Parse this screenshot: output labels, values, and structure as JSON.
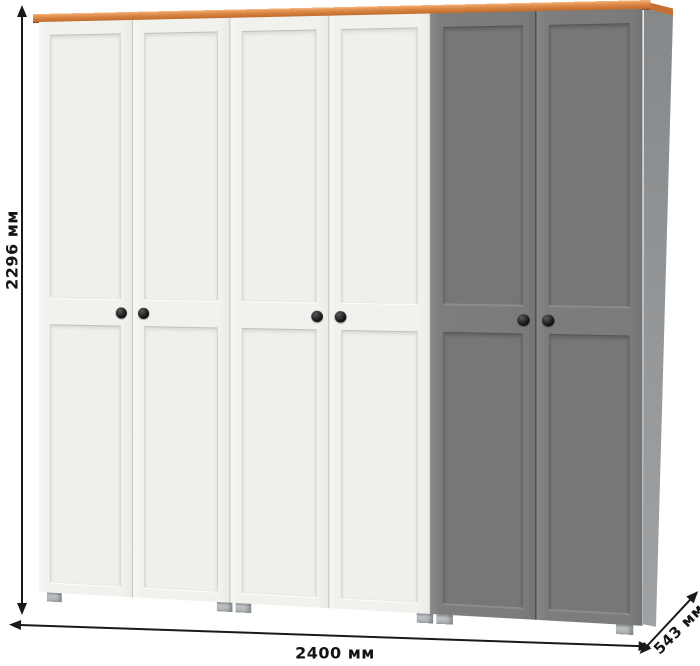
{
  "image": {
    "description": "Six-door wardrobe (four white doors, two gray doors) with orange wood top trim, black round knobs and small gray feet, annotated with overall dimensions"
  },
  "dimensions": {
    "height": {
      "label": "2296 мм",
      "value": 2296,
      "unit": "мм"
    },
    "width": {
      "label": "2400 мм",
      "value": 2400,
      "unit": "мм"
    },
    "depth": {
      "label": "543 мм",
      "value": 543,
      "unit": "мм"
    }
  },
  "wardrobe": {
    "door_count": 6,
    "door_colors": [
      "white",
      "white",
      "white",
      "white",
      "gray",
      "gray"
    ],
    "knob_color": "#1c1c1c",
    "colors": {
      "top_trim": "#d5803e",
      "white_door": "#f1f2ee",
      "gray_door": "#7b7b7b",
      "side_panel": "#8d9092",
      "feet": "#b3b8ba",
      "dimension_lines": "#191919"
    }
  }
}
